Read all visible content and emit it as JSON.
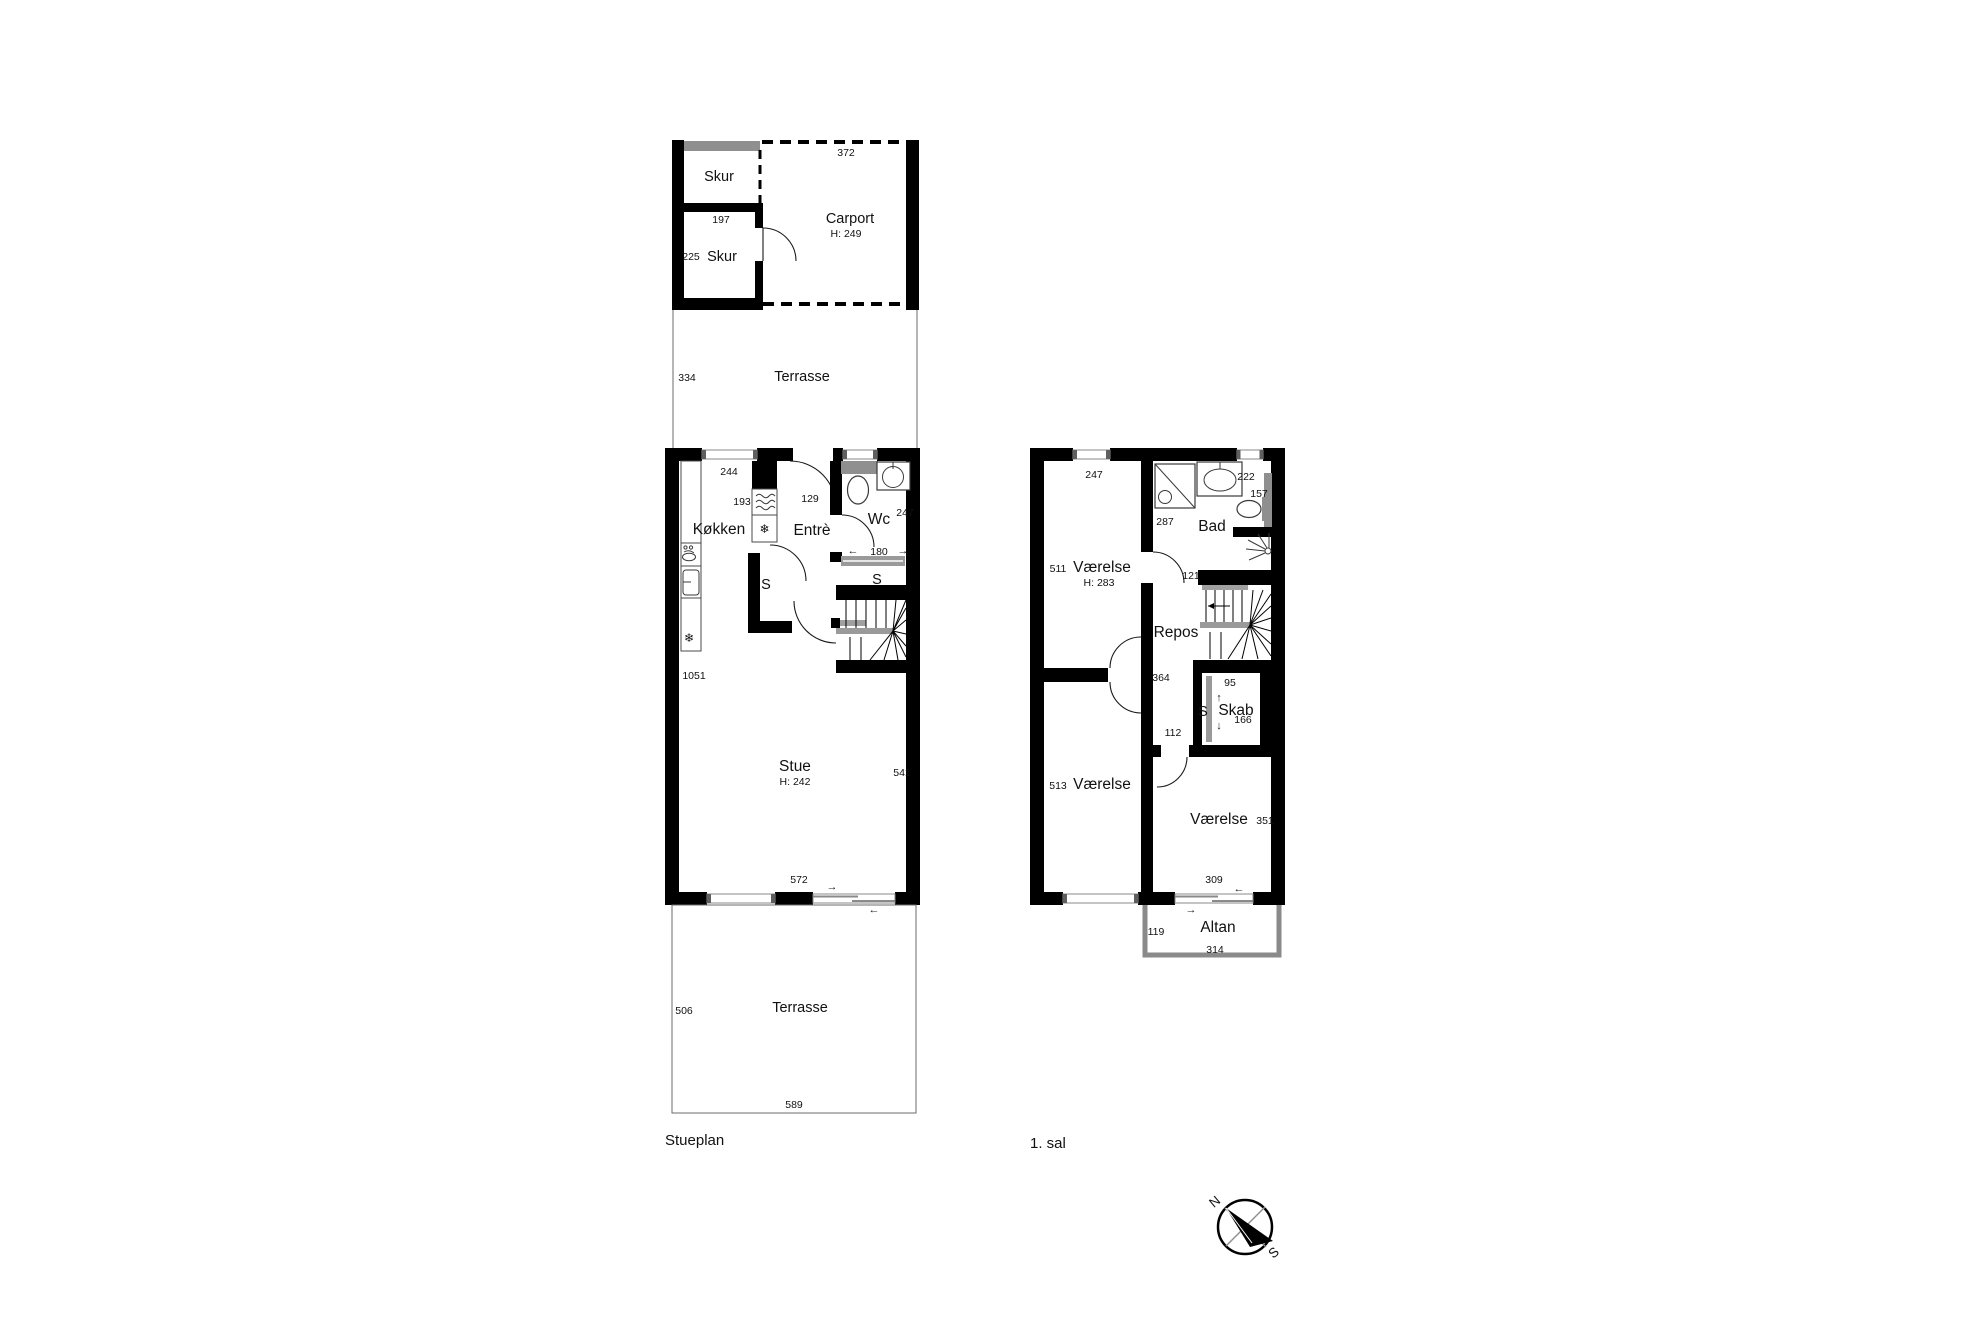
{
  "titles": {
    "ground": "Stueplan",
    "first": "1. sal"
  },
  "ground": {
    "skur_upper_label": "Skur",
    "skur_upper_width": "197",
    "skur_lower_dim": "225",
    "skur_lower_label": "Skur",
    "carport_width": "372",
    "carport_label": "Carport",
    "carport_height": "H: 249",
    "terrace_upper_depth": "334",
    "terrace_upper_label": "Terrasse",
    "kitchen_window": "244",
    "kitchen_dim": "193",
    "kitchen_label": "Køkken",
    "entre_dim": "129",
    "entre_label": "Entrè",
    "wc_label": "Wc",
    "wc_dim": "247",
    "wc_width": "180",
    "closet_entre": "S",
    "closet_wc": "S",
    "house_depth": "1051",
    "stue_label": "Stue",
    "stue_height": "H: 242",
    "stue_dim": "541",
    "stue_width": "572",
    "terrace_lower_depth": "506",
    "terrace_lower_label": "Terrasse",
    "terrace_lower_width": "589"
  },
  "first": {
    "room_nw_window": "247",
    "bad_dim": "287",
    "bad_label": "Bad",
    "bad_window": "222",
    "toilet_dim": "157",
    "room_nw_dim": "511",
    "room_nw_label": "Værelse",
    "room_nw_height": "H: 283",
    "door_dim": "121",
    "repos_label": "Repos",
    "repos_dim": "364",
    "skab_top_dim": "95",
    "skab_s": "S",
    "skab_label": "Skab",
    "skab_dim": "166",
    "door2_dim": "112",
    "room_sw_dim": "513",
    "room_sw_label": "Værelse",
    "room_se_label": "Værelse",
    "room_se_dim": "351",
    "window_se": "309",
    "altan_depth": "119",
    "altan_label": "Altan",
    "altan_width": "314"
  },
  "icons": {
    "arrow_up": "↑",
    "arrow_down": "↓",
    "arrow_left": "←",
    "arrow_right": "→",
    "snowflake": "❄",
    "compass_n": "N",
    "compass_s": "S"
  },
  "colors": {
    "wall": "#000000",
    "window_gray": "#8a8a8a",
    "terrace_line": "#555555",
    "rail_gray": "#9a9a9a"
  }
}
